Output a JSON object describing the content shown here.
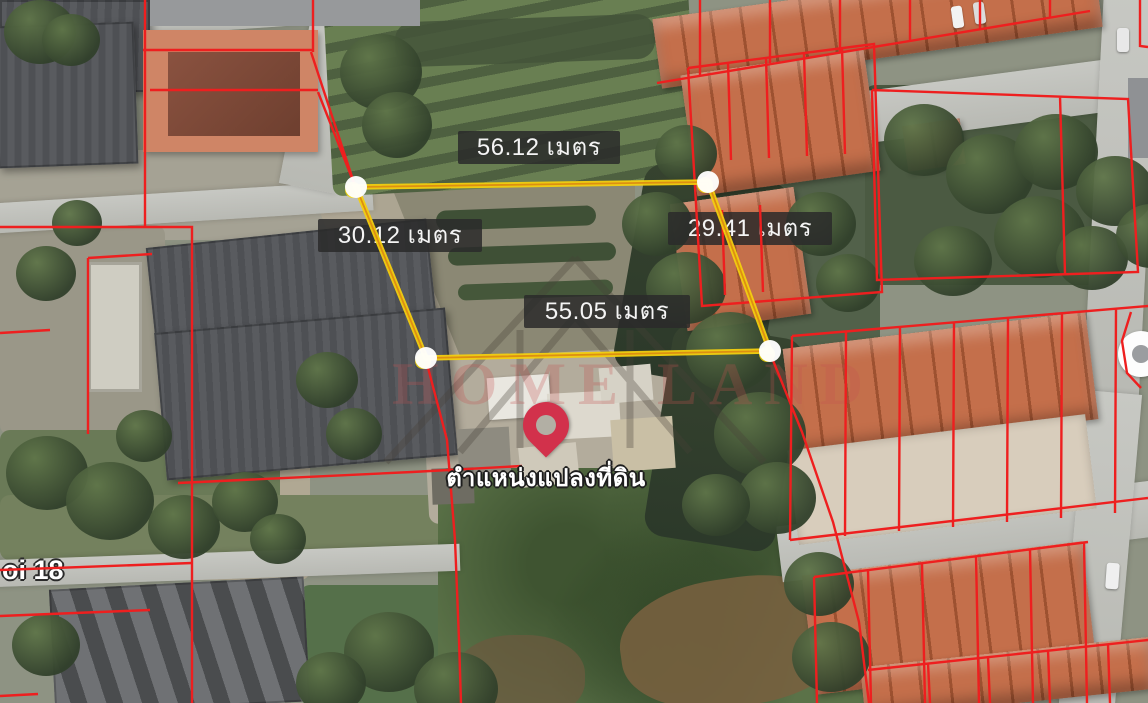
{
  "map": {
    "street_label": "oi 18",
    "pin_caption": "ตำแหน่งแปลงที่ดิน",
    "watermark": "HOME LAND"
  },
  "plot": {
    "side_labels": {
      "top": "56.12 เมตร",
      "left": "30.12 เมตร",
      "right": "29.41 เมตร",
      "bottom": "55.05 เมตร"
    },
    "measure_unit": "เมตร",
    "colors": {
      "plot_outline": "#f3cf0f",
      "plot_outline_core": "#dd8f12",
      "cadastral_line": "#ee1f1f",
      "pin": "#d2314b",
      "vertex_marker": "#ffffff",
      "label_background": "rgba(42,42,42,0.85)"
    }
  }
}
